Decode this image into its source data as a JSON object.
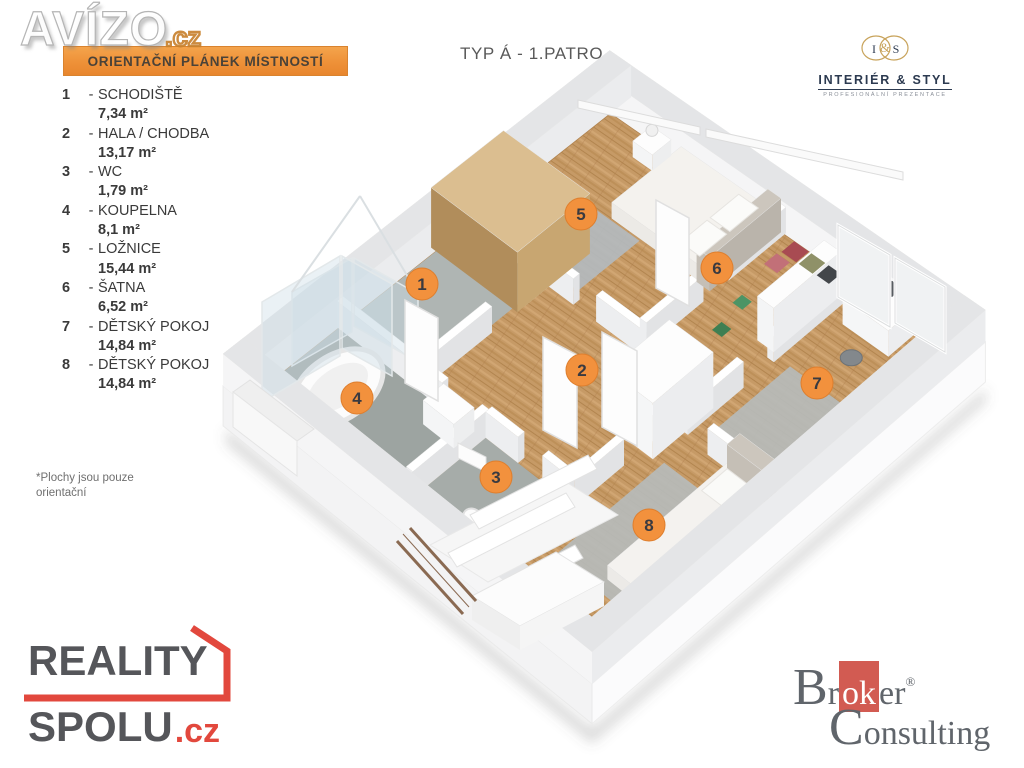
{
  "watermark": {
    "name": "AVÍZO",
    "tld": ".cz"
  },
  "banner": {
    "label": "ORIENTAČNÍ PLÁNEK MÍSTNOSTÍ"
  },
  "plan_title": "TYP Á - 1.PATRO",
  "interier_styl": {
    "initial_left": "I",
    "amp": "&",
    "initial_right": "S",
    "name": "INTERIÉR & STYL",
    "tagline": "PROFESIONÁLNÍ PREZENTACE"
  },
  "legend": {
    "sep": "-",
    "items": [
      {
        "number": "1",
        "label": "SCHODIŠTĚ",
        "area": "7,34 m²"
      },
      {
        "number": "2",
        "label": "HALA / CHODBA",
        "area": "13,17 m²"
      },
      {
        "number": "3",
        "label": "WC",
        "area": "1,79 m²"
      },
      {
        "number": "4",
        "label": "KOUPELNA",
        "area": "8,1 m²"
      },
      {
        "number": "5",
        "label": "LOŽNICE",
        "area": "15,44 m²"
      },
      {
        "number": "6",
        "label": "ŠATNA",
        "area": "6,52 m²"
      },
      {
        "number": "7",
        "label": "DĚTSKÝ POKOJ",
        "area": "14,84 m²"
      },
      {
        "number": "8",
        "label": "DĚTSKÝ POKOJ",
        "area": "14,84 m²"
      }
    ]
  },
  "footnote": {
    "line1": "*Plochy jsou pouze",
    "line2": "orientační"
  },
  "reality_spolu": {
    "word1": "REALITY",
    "word2": "SPOLU",
    "tld": ".cz"
  },
  "broker": {
    "pre": "Br",
    "highlight": "ok",
    "post": "er",
    "reg": "®",
    "line2": "Consulting"
  },
  "colors": {
    "accent_orange": "#F2913D",
    "marker_border": "#DE7E2D",
    "banner_orange": "#EE9138",
    "brand_red": "#E2483D",
    "broker_red": "#D25B52",
    "gold": "#C8A35B",
    "navy": "#2C3A50"
  }
}
